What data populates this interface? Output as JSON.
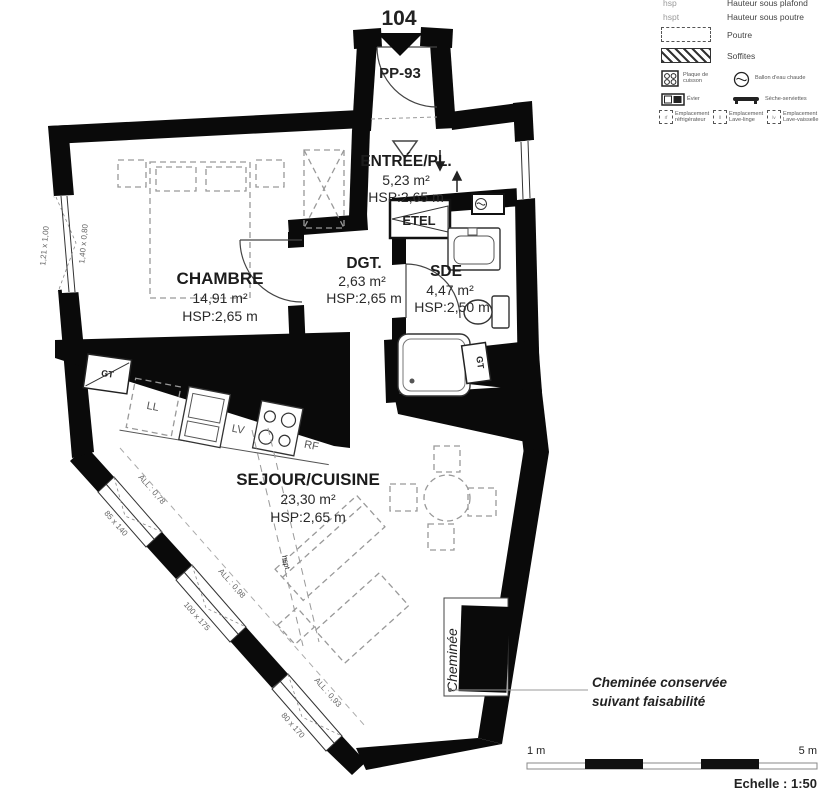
{
  "header": {
    "unit_number": "104",
    "door_label": "PP-93"
  },
  "rooms": {
    "entree": {
      "name": "ENTRÉE/PL.",
      "area": "5,23 m²",
      "height": "HSP:2,65 m"
    },
    "chambre": {
      "name": "CHAMBRE",
      "area": "14,91 m²",
      "height": "HSP:2,65 m"
    },
    "dgt": {
      "name": "DGT.",
      "area": "2,63 m²",
      "height": "HSP:2,65 m"
    },
    "sde": {
      "name": "SDE",
      "area": "4,47 m²",
      "height": "HSP:2,50 m"
    },
    "sejour": {
      "name": "SEJOUR/CUISINE",
      "area": "23,30 m²",
      "height": "HSP:2,65 m"
    }
  },
  "labels": {
    "etel": "ETEL",
    "gt": "GT",
    "ll": "LL",
    "lv": "LV",
    "rf": "RF",
    "cheminee": "Cheminée",
    "beam": "hspt"
  },
  "windows": {
    "left_dim": "1,21 x 1,00",
    "left_dim2": "1,40 x 0,80",
    "w1_sill": "ALL : 0,78",
    "w1_dim": "85 x 140",
    "w2_sill": "ALL : 0,98",
    "w2_dim": "100 x 175",
    "w3_sill": "ALL : 0,93",
    "w3_dim": "80 x 170"
  },
  "legend": {
    "hsp_key": "hsp",
    "hsp_label": "Hauteur sous plafond",
    "hspt_key": "hspt",
    "hspt_label": "Hauteur sous poutre",
    "poutre": "Poutre",
    "soffites": "Soffites",
    "cooktop": "Plaque de cuisson",
    "ballon": "Ballon d'eau chaude",
    "evier": "Évier",
    "seche": "Sèche-serviettes",
    "empl_rf": "Emplacement réfrigérateur",
    "empl_ll": "Emplacement Lave-linge",
    "empl_lv": "Emplacement Lave-vaisselle",
    "tag_rf": "rf",
    "tag_ll": "ll",
    "tag_lv": "lv"
  },
  "annotation": {
    "line1": "Cheminée conservée",
    "line2": "suivant faisabilité"
  },
  "scale": {
    "start": "1 m",
    "end": "5 m",
    "caption": "Echelle : 1:50"
  },
  "colors": {
    "accent_teal": "#2fa3b5",
    "door_label": "#44546a"
  }
}
